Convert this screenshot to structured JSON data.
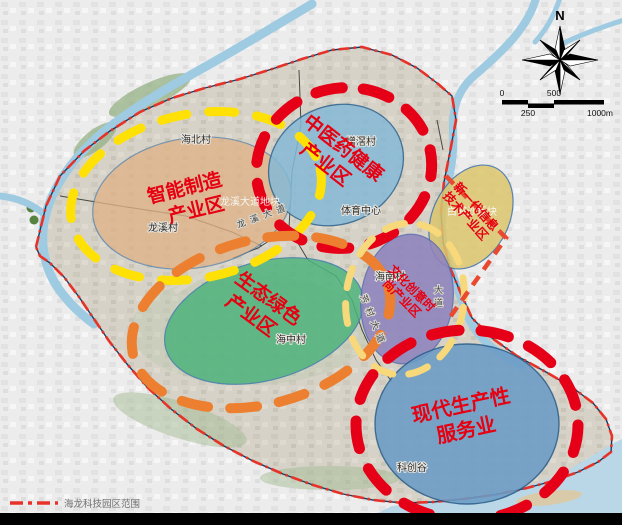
{
  "legend": {
    "boundary_label": "海龙科技园区范围"
  },
  "compass": {
    "north_label": "N"
  },
  "scale_bar": {
    "start": "0",
    "quarter": "250",
    "mid": "500",
    "end": "1000m"
  },
  "zones": [
    {
      "name": "智能制造产业区",
      "line1": "智能制造",
      "line2": "产业区",
      "fill": "#e0b287",
      "ring_color": "#ffe105"
    },
    {
      "name": "中医药健康产业区",
      "line1": "中医药健康",
      "line2": "产业区",
      "fill": "#85b9d6",
      "ring_color": "#e60017"
    },
    {
      "name": "新一代信息技术产业区",
      "line1": "新一代信息",
      "line2": "技术产业区",
      "fill": "#dcc66c",
      "ring_color": "#e8492f"
    },
    {
      "name": "生态绿色产业区",
      "line1": "生态绿色",
      "line2": "产业区",
      "fill": "#4eb47c",
      "ring_color": "#ec8030"
    },
    {
      "name": "文化创意时尚产业区",
      "line1": "文化创意时",
      "line2": "尚产业区",
      "fill": "#8f83bd",
      "ring_color": "#f7d87b"
    },
    {
      "name": "现代生产性服务业",
      "line1": "现代生产性",
      "line2": "服务业",
      "fill": "#6b9cc6",
      "ring_color": "#e60017"
    }
  ],
  "places": {
    "haibei": "海北村",
    "zengjiao": "增滘村",
    "longxi": "龙溪村",
    "sports_center": "体育中心",
    "haizhong": "海中村",
    "hainan": "海南村",
    "kechuanggu": "科创谷",
    "longxi_plot": "龙溪大道地块",
    "baihesha_plot": "白鹤沙板块"
  },
  "roads": {
    "longxi_avenue": "龙溪大道",
    "fangcun_avenue": "芳村大道",
    "avenue": "大道"
  },
  "colors": {
    "zone_label_red": "#e60012",
    "park_boundary_red": "#e63329",
    "river_blue": "#9ecbe2"
  }
}
